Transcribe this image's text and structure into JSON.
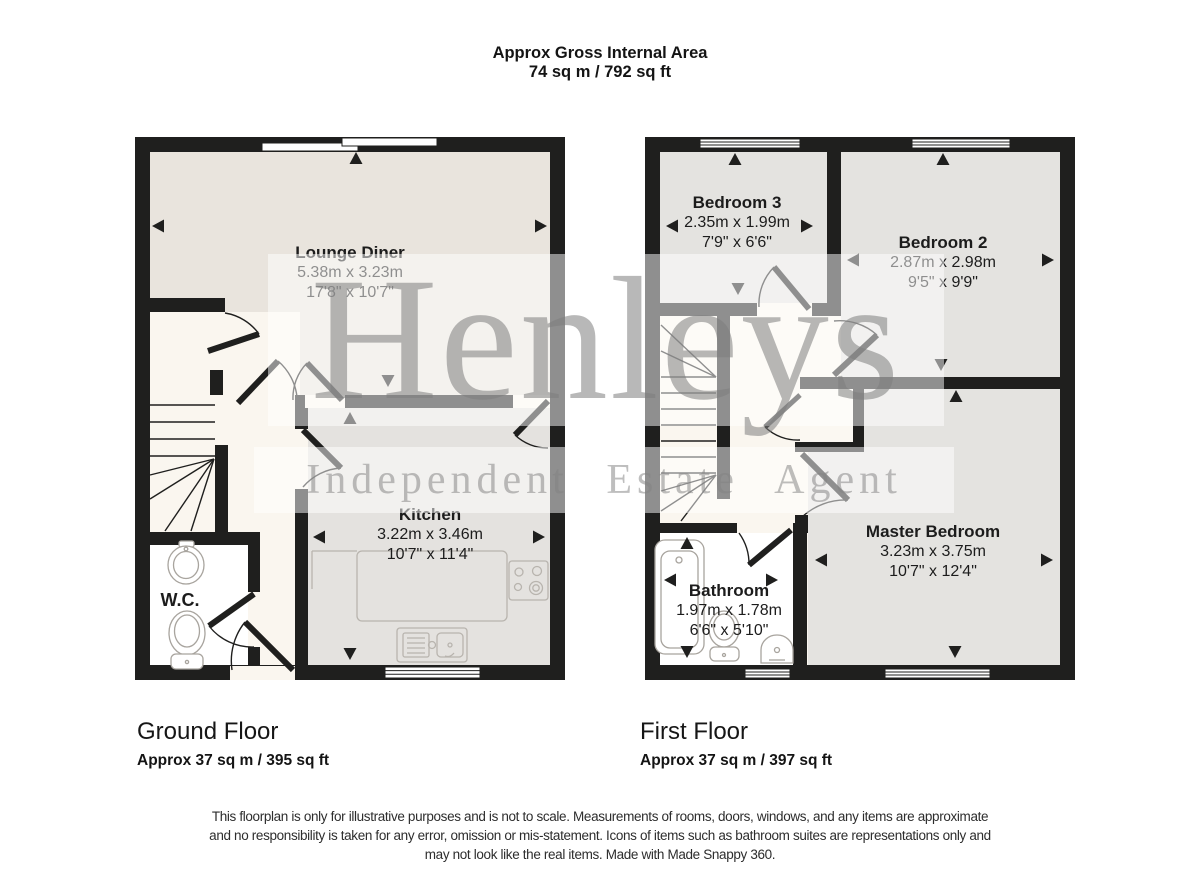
{
  "header": {
    "title": "Approx Gross Internal Area",
    "value": "74 sq m / 792 sq ft"
  },
  "floors": [
    {
      "id": "ground-floor",
      "title": "Ground Floor",
      "area": "Approx 37 sq m / 395 sq ft",
      "rooms": [
        {
          "name": "Lounge Diner",
          "metric": "5.38m x 3.23m",
          "imperial": "17'8\" x 10'7\""
        },
        {
          "name": "Kitchen",
          "metric": "3.22m x 3.46m",
          "imperial": "10'7\" x 11'4\""
        },
        {
          "name": "W.C.",
          "metric": "",
          "imperial": ""
        }
      ]
    },
    {
      "id": "first-floor",
      "title": "First Floor",
      "area": "Approx 37 sq m / 397 sq ft",
      "rooms": [
        {
          "name": "Bedroom 3",
          "metric": "2.35m x 1.99m",
          "imperial": "7'9\" x 6'6\""
        },
        {
          "name": "Bedroom 2",
          "metric": "2.87m x 2.98m",
          "imperial": "9'5\" x 9'9\""
        },
        {
          "name": "Master Bedroom",
          "metric": "3.23m x 3.75m",
          "imperial": "10'7\" x 12'4\""
        },
        {
          "name": "Bathroom",
          "metric": "1.97m x 1.78m",
          "imperial": "6'6\" x 5'10\""
        }
      ]
    }
  ],
  "watermark": {
    "brand": "Henleys",
    "tagline": "Independent Estate Agent"
  },
  "disclaimer": {
    "line1": "This floorplan is only for illustrative purposes and is not to scale. Measurements of rooms, doors, windows, and any items are approximate",
    "line2": "and no responsibility is taken for any error, omission or mis-statement. Icons of items such as bathroom suites are representations only and",
    "line3": "may not look like the real items. Made with Made Snappy 360."
  },
  "colors": {
    "wall": "#1f1f1e",
    "lounge_fill": "#e9e4dd",
    "kitchen_fill": "#e4e2df",
    "bedroom_fill": "#e4e3e0",
    "hall_fill": "#faf6ef",
    "wet_room_fill": "#ffffff",
    "fixture_outline": "#a8a49e",
    "watermark_gray": "#808080"
  },
  "icons": {
    "window": "triple-line-band",
    "door": "quarter-arc-with-leaf",
    "stairs": "treads-with-winder-fan",
    "measure-arrow": "small-filled-triangle",
    "toilet": "oval-bowl-with-cistern",
    "basin": "oval-with-tap",
    "pedestal-basin": "arched-bowl",
    "bathtub": "rounded-rect-with-inner",
    "hob": "square-with-four-rings",
    "kitchen-sink": "drainer-and-basin"
  }
}
